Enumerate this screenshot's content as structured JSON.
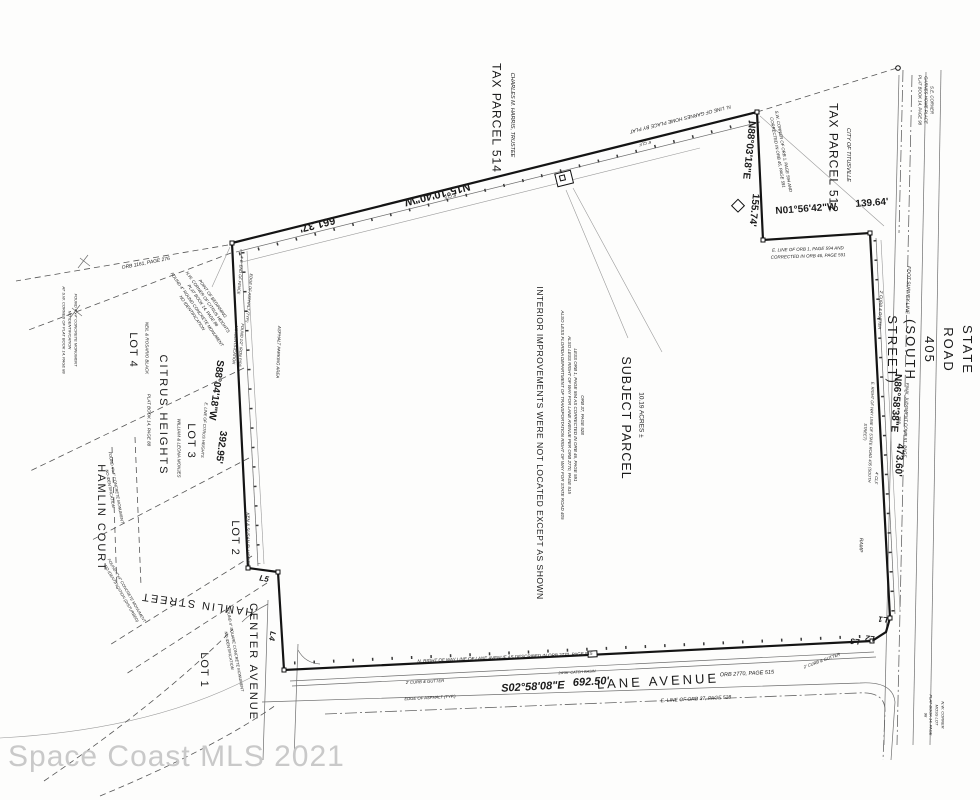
{
  "watermark": "Space Coast MLS 2021",
  "colors": {
    "ink": "#141414",
    "thin_line": "#6e6e6e",
    "watermark": "#c9c9c9"
  },
  "labels": [
    {
      "n": "tax-parcel-514-label",
      "t": "TAX PARCEL 514",
      "x": 496,
      "y": 118,
      "r": 90,
      "fs": 12,
      "ls": 1
    },
    {
      "n": "tax-parcel-514-owner",
      "t": "CHARLES M. HARRIS, TRUSTEE",
      "x": 511,
      "y": 115,
      "r": 90,
      "fs": 5.5,
      "i": 1
    },
    {
      "n": "bearing-top-direction",
      "t": "N15°10'40\"W",
      "x": 437,
      "y": 193,
      "r": 166,
      "fs": 11,
      "b": 1
    },
    {
      "n": "bearing-top-distance",
      "t": "661.37'",
      "x": 317,
      "y": 223,
      "r": 166,
      "fs": 11,
      "b": 1
    },
    {
      "n": "garnes-line-note",
      "t": "N. LINE OF GARNES HOME PLACE BY PLAT",
      "x": 680,
      "y": 118,
      "r": 166,
      "fs": 5,
      "i": 1
    },
    {
      "n": "tax-parcel-512-label",
      "t": "TAX PARCEL 512",
      "x": 833,
      "y": 158,
      "r": 90,
      "fs": 12,
      "ls": 1
    },
    {
      "n": "tax-parcel-512-owner",
      "t": "CITY OF TITUSVILLE",
      "x": 847,
      "y": 155,
      "r": 90,
      "fs": 5.5,
      "i": 1
    },
    {
      "n": "bearing-ne-direction",
      "t": "N88°03'18\"E",
      "x": 748,
      "y": 150,
      "r": 96,
      "fs": 10,
      "b": 1
    },
    {
      "n": "bearing-ne-distance",
      "t": "155.74'",
      "x": 753,
      "y": 210,
      "r": 96,
      "fs": 10,
      "b": 1
    },
    {
      "n": "sw-corner-orb-note",
      "t": "S.W. CORNER OF ORB 1, PAGE 594 AND\nCORRECTED IN ORB 46, PAGE 591",
      "x": 780,
      "y": 152,
      "r": 80,
      "fs": 4.3,
      "i": 1
    },
    {
      "n": "bearing-n01-direction",
      "t": "N01°56'42\"W",
      "x": 806,
      "y": 210,
      "r": -4,
      "fs": 10,
      "b": 1
    },
    {
      "n": "bearing-n01-distance",
      "t": "139.64'",
      "x": 872,
      "y": 204,
      "r": -4,
      "fs": 10,
      "b": 1
    },
    {
      "n": "se-corner-garnes-note",
      "t": "S.E. CORNER\nGARNES HOME PLACE\nPLAT BOOK 14, PAGE 98",
      "x": 925,
      "y": 100,
      "r": 90,
      "fs": 4.3,
      "i": 1
    },
    {
      "n": "e-line-orb1-note",
      "t": "E. LINE OF ORB 1, PAGE 594 AND\nCORRECTED IN ORB 46, PAGE 591",
      "x": 808,
      "y": 253,
      "r": -2,
      "fs": 4.5,
      "i": 1
    },
    {
      "n": "state-road-405-label",
      "t": "STATE ROAD 405  (SOUTH STREET)",
      "x": 929,
      "y": 350,
      "r": 90,
      "fs": 13,
      "ls": 2
    },
    {
      "n": "fdot-survey-line-note",
      "t": "FDOT SURVEY LINE",
      "x": 907,
      "y": 290,
      "r": 92,
      "fs": 5,
      "i": 1
    },
    {
      "n": "final-judgment-note",
      "t": "FINAL JUDGMENT COMB 51, PAGE 398",
      "x": 902,
      "y": 420,
      "r": 92,
      "fs": 4.5,
      "i": 1
    },
    {
      "n": "bearing-right-direction",
      "t": "N86°58'38\"E",
      "x": 895,
      "y": 403,
      "r": 94,
      "fs": 10,
      "b": 1
    },
    {
      "n": "bearing-right-distance",
      "t": "473.60'",
      "x": 898,
      "y": 460,
      "r": 94,
      "fs": 10,
      "b": 1
    },
    {
      "n": "e-row-sr405-note",
      "t": "E. RIGHT OF WAY LINE OF STATE ROAD 405 (SOUTH STREET)",
      "x": 868,
      "y": 432,
      "r": 92,
      "fs": 4,
      "i": 1
    },
    {
      "n": "ramp-note",
      "t": "RAMP",
      "x": 860,
      "y": 545,
      "r": 92,
      "fs": 5,
      "i": 1
    },
    {
      "n": "curb-gutter-right-note",
      "t": "2' CURB & GUTTER",
      "x": 880,
      "y": 310,
      "r": 93,
      "fs": 4.2,
      "i": 1
    },
    {
      "n": "clf-right-note",
      "t": "4' CLF",
      "x": 876,
      "y": 478,
      "r": 94,
      "fs": 4.2,
      "i": 1
    },
    {
      "n": "subject-parcel-label",
      "t": "SUBJECT PARCEL",
      "x": 626,
      "y": 418,
      "r": 90,
      "fs": 12.5,
      "ls": 1
    },
    {
      "n": "subject-parcel-acreage",
      "t": "10.19 ACRES ±",
      "x": 641,
      "y": 415,
      "r": 90,
      "fs": 6.5
    },
    {
      "n": "legal-description-note",
      "t": "ORB 37, PAGE 528\nLESS ORB 1, PAGE 594 AS CORRECTED IN ORB 46, PAGE 591\nALSO LESS RIGHT OF WAY FOR LANE AVENUE PER ORB 2770, PAGE 515\nALSO LESS FLORIDA DEPARTMENT OF TRANSPORTATION RIGHT OF WAY FOR STATE ROAD 405",
      "x": 572,
      "y": 415,
      "r": 90,
      "fs": 4.5,
      "i": 1
    },
    {
      "n": "interior-improvements-note",
      "t": "INTERIOR IMPROVEMENTS WERE NOT LOCATED EXCEPT AS SHOWN",
      "x": 540,
      "y": 443,
      "r": 90,
      "fs": 8.5,
      "ls": 0.5
    },
    {
      "n": "bearing-left-direction",
      "t": "S88°04'18\"W",
      "x": 215,
      "y": 390,
      "r": 98,
      "fs": 10,
      "b": 1
    },
    {
      "n": "bearing-left-distance",
      "t": "392.95'",
      "x": 220,
      "y": 447,
      "r": 98,
      "fs": 10,
      "b": 1
    },
    {
      "n": "e-line-citrus-note",
      "t": "E. LINE OF CITRUS HEIGHTS",
      "x": 204,
      "y": 430,
      "r": 94,
      "fs": 4,
      "i": 1
    },
    {
      "n": "citrus-heights-label",
      "t": "CITRUS  HEIGHTS",
      "x": 162,
      "y": 415,
      "r": 90,
      "fs": 11,
      "ls": 2
    },
    {
      "n": "citrus-heights-plat-note",
      "t": "PLAT BOOK 14, PAGE 88",
      "x": 148,
      "y": 420,
      "r": 90,
      "fs": 4.5,
      "i": 1
    },
    {
      "n": "lot-4-label",
      "t": "LOT 4",
      "x": 132,
      "y": 350,
      "r": 90,
      "fs": 11,
      "ls": 1
    },
    {
      "n": "lot-4-owner",
      "t": "NEIL & ROSARIO BLACK",
      "x": 146,
      "y": 348,
      "r": 90,
      "fs": 4.5,
      "i": 1
    },
    {
      "n": "lot-3-label",
      "t": "LOT 3",
      "x": 190,
      "y": 441,
      "r": 90,
      "fs": 11,
      "ls": 1
    },
    {
      "n": "lot-3-owner",
      "t": "WILLIAM & LEONA MONJES",
      "x": 178,
      "y": 448,
      "r": 90,
      "fs": 4.5,
      "i": 1
    },
    {
      "n": "lot-2-label",
      "t": "LOT 2",
      "x": 234,
      "y": 538,
      "r": 90,
      "fs": 11,
      "ls": 1
    },
    {
      "n": "lot-2-owner",
      "t": "KEN & SUSAN ELLICOTT",
      "x": 247,
      "y": 539,
      "r": 90,
      "fs": 4.5,
      "i": 1
    },
    {
      "n": "lot-1-label",
      "t": "LOT 1",
      "x": 203,
      "y": 670,
      "r": 90,
      "fs": 11,
      "ls": 1
    },
    {
      "n": "hamlin-court-label",
      "t": "HAMLIN  COURT",
      "x": 100,
      "y": 518,
      "r": 90,
      "fs": 11,
      "ls": 2
    },
    {
      "n": "hamlin-street-label",
      "t": "HAMLIN  STREET",
      "x": 197,
      "y": 603,
      "r": 188,
      "fs": 11,
      "ls": 2
    },
    {
      "n": "center-avenue-label",
      "t": "CENTER  AVENUE",
      "x": 252,
      "y": 662,
      "r": 90,
      "fs": 11,
      "ls": 2
    },
    {
      "n": "lane-avenue-label",
      "t": "LANE  AVENUE",
      "x": 658,
      "y": 682,
      "r": -3,
      "fs": 13,
      "ls": 3
    },
    {
      "n": "lane-avenue-orb-note",
      "t": "ORB 2770, PAGE 515",
      "x": 747,
      "y": 675,
      "r": -3,
      "fs": 5.5,
      "i": 1
    },
    {
      "n": "bearing-bottom-direction",
      "t": "S02°58'08\"E",
      "x": 533,
      "y": 688,
      "r": -3,
      "fs": 11,
      "b": 1,
      "i": 1
    },
    {
      "n": "bearing-bottom-distance",
      "t": "692.50'",
      "x": 591,
      "y": 683,
      "r": -3,
      "fs": 11,
      "b": 1,
      "i": 1
    },
    {
      "n": "n-row-lane-note",
      "t": "N. RIGHT OF WAY LINE OF LANE AVENUE AS DESCRIBED IN ORB 2770, PAGE 515",
      "x": 505,
      "y": 658,
      "r": -2.5,
      "fs": 4.5,
      "i": 1
    },
    {
      "n": "e-line-orb37-note",
      "t": "E. LINE OF ORB 37, PAGE 528",
      "x": 696,
      "y": 700,
      "r": -3,
      "fs": 5,
      "i": 1
    },
    {
      "n": "curb-gutter-bottom-note",
      "t": "2' CURB & GUTTER",
      "x": 425,
      "y": 682,
      "r": -3,
      "fs": 4.2,
      "i": 1
    },
    {
      "n": "edge-asphalt-bottom-note",
      "t": "EDGE OF ASPHALT (TYP.)",
      "x": 430,
      "y": 698,
      "r": -3,
      "fs": 4.2,
      "i": 1
    },
    {
      "n": "catch-basin-note",
      "t": "24/36\" CATCH BASIN",
      "x": 577,
      "y": 673,
      "r": -3,
      "fs": 3.8,
      "i": 1
    },
    {
      "n": "curb-gutter-corner-note",
      "t": "2' CURB & GUTTER",
      "x": 822,
      "y": 661,
      "r": -20,
      "fs": 4.2,
      "i": 1
    },
    {
      "n": "point-of-beginning-note",
      "t": "POINT OF BEGINNING\nN.W. CORNER OF CITRUS HEIGHTS\nPLAT BOOK 14, PAGE 88\nFOUND 4\" ROUND CONCRETE MONUMENT\nNO IDENTIFICATION",
      "x": 202,
      "y": 306,
      "r": 55,
      "fs": 4.3,
      "i": 1
    },
    {
      "n": "orb-1161-note",
      "t": "ORB 1161, PAGE 276",
      "x": 146,
      "y": 264,
      "r": -11,
      "fs": 5,
      "i": 1
    },
    {
      "n": "found-monument-sw-note",
      "t": "FOUND 4\"x4\" CONCRETE MONUMENT\nNO IDENTIFICATION\nAT S.W. CORNER OF PLAT BOOK 14, PAGE 88",
      "x": 70,
      "y": 330,
      "r": 90,
      "fs": 4,
      "i": 1
    },
    {
      "n": "found-monument-court-note",
      "t": "FOUND 4\"x4\" CONCRETE MONUMENT\nNO IDENTIFICATION",
      "x": 113,
      "y": 488,
      "r": 80,
      "fs": 4,
      "i": 1
    },
    {
      "n": "found-monument-disturbed-note",
      "t": "FOUND 4\"x4\" CONCRETE MONUMENT\nNO IDENTIFICATION (DISTURBED)",
      "x": 124,
      "y": 592,
      "r": 60,
      "fs": 4,
      "i": 1
    },
    {
      "n": "found-monument-center-note",
      "t": "FOUND 4\" SQUARE CONCRETE MONUMENT\nNO IDENTIFICATION",
      "x": 232,
      "y": 650,
      "r": 80,
      "fs": 4,
      "i": 1
    },
    {
      "n": "asphalt-parking-note",
      "t": "ASPHALT PARKING AREA",
      "x": 278,
      "y": 352,
      "r": 92,
      "fs": 4.3,
      "i": 1
    },
    {
      "n": "found-pipe-note",
      "t": "FOUND 1/2\" IRON PIPE\nNO IDENTIFICATION",
      "x": 238,
      "y": 345,
      "r": 94,
      "fs": 4,
      "i": 1
    },
    {
      "n": "l1-label",
      "t": "L1",
      "x": 883,
      "y": 619,
      "r": 185,
      "fs": 8,
      "b": 1,
      "i": 1
    },
    {
      "n": "l2-label",
      "t": "L2",
      "x": 870,
      "y": 638,
      "r": 185,
      "fs": 8,
      "b": 1,
      "i": 1
    },
    {
      "n": "l3-label",
      "t": "L3",
      "x": 855,
      "y": 641,
      "r": 185,
      "fs": 8,
      "b": 1,
      "i": 1
    },
    {
      "n": "l4-label",
      "t": "L4",
      "x": 272,
      "y": 636,
      "r": 100,
      "fs": 8,
      "b": 1,
      "i": 1
    },
    {
      "n": "l5-label",
      "t": "L5",
      "x": 264,
      "y": 579,
      "r": 10,
      "fs": 8,
      "b": 1,
      "i": 1
    },
    {
      "n": "nw-corner-moss-note",
      "t": "N.W. CORNER\nMOSS LOT\nPLAT BOOK 14, PAGE 98",
      "x": 934,
      "y": 715,
      "r": 90,
      "fs": 4,
      "i": 1
    },
    {
      "n": "clf-top-note-1",
      "t": "6' CLF",
      "x": 450,
      "y": 196,
      "r": 166,
      "fs": 4.2,
      "i": 1
    },
    {
      "n": "clf-top-note-2",
      "t": "6' CLF",
      "x": 645,
      "y": 143,
      "r": 166,
      "fs": 4.2,
      "i": 1
    },
    {
      "n": "edge-asphalt-left-note",
      "t": "EDGE OF ASPHALT (TYP.)",
      "x": 249,
      "y": 298,
      "r": 95,
      "fs": 4,
      "i": 1
    },
    {
      "n": "fence-end-note",
      "t": "4' E. END OF FENCE",
      "x": 240,
      "y": 275,
      "r": 95,
      "fs": 4,
      "i": 1
    }
  ]
}
